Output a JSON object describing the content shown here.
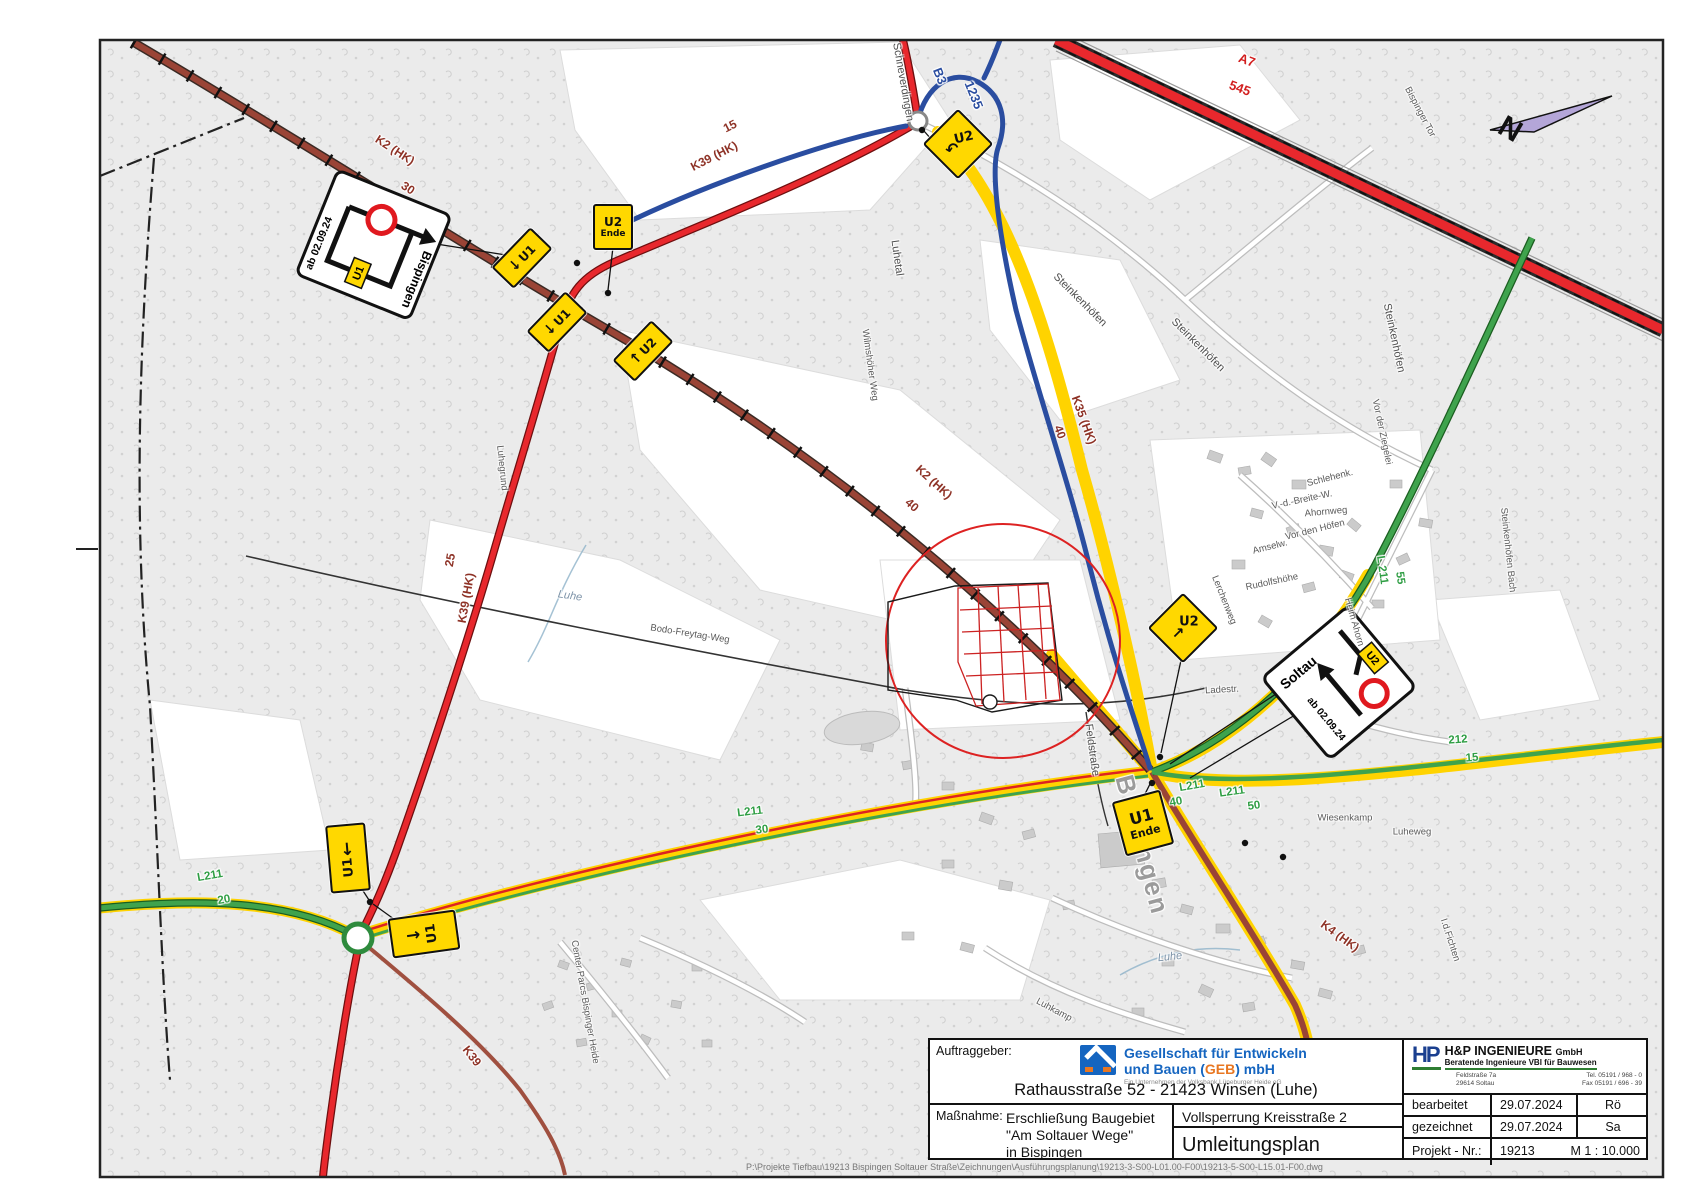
{
  "title_block": {
    "client_label": "Auftraggeber:",
    "client": {
      "name_line1": "Gesellschaft für Entwickeln",
      "name_line2_pre": "und Bauen (",
      "name_geb": "GEB",
      "name_line2_post": ") mbH",
      "sub": "Ein Unternehmen der Volksbank Lüneburger Heide eG",
      "address": "Rathausstraße 52 - 21423 Winsen (Luhe)"
    },
    "measure_label": "Maßnahme:",
    "measure_line1": "Erschließung Baugebiet",
    "measure_line2": "\"Am Soltauer Wege\"",
    "measure_line3": "in Bispingen",
    "closure": "Vollsperrung Kreisstraße 2",
    "plan_title": "Umleitungsplan",
    "engineer": {
      "logo": "HP",
      "name": "H&P INGENIEURE",
      "suffix": "GmbH",
      "sub": "Beratende Ingenieure VBI für Bauwesen",
      "addr1": "Feldstraße 7a",
      "addr2": "29614 Soltau",
      "tel": "Tel. 05191 / 968 - 0",
      "fax": "Fax 05191 / 696 - 39"
    },
    "rows": [
      {
        "label": "bearbeitet",
        "date": "29.07.2024",
        "by": "Rö"
      },
      {
        "label": "gezeichnet",
        "date": "29.07.2024",
        "by": "Sa"
      }
    ],
    "project_label": "Projekt - Nr.:",
    "project_no": "19213",
    "scale": "M 1 : 10.000"
  },
  "page": {
    "file_path": "P:\\Projekte Tiefbau\\19213 Bispingen Soltauer Straße\\Zeichnungen\\Ausführungsplanung\\19213-3-S00-L01.00-F00\\19213-5-S00-L15.01-F00.dwg"
  },
  "signs": {
    "bispingen": {
      "dest": "Bispingen",
      "date": "ab 02.09.24",
      "badge": "U1"
    },
    "soltau": {
      "dest": "Soltau",
      "date": "ab 02.09.24",
      "badge": "U2"
    }
  },
  "map": {
    "north": "N",
    "labels": [
      {
        "t": "Schneverdingen",
        "x": 903,
        "y": 82,
        "r": 80,
        "c": "m"
      },
      {
        "t": "B3",
        "x": 940,
        "y": 76,
        "r": 68,
        "c": "bl"
      },
      {
        "t": "1235",
        "x": 974,
        "y": 95,
        "r": 68,
        "c": "bl"
      },
      {
        "t": "A7",
        "x": 1247,
        "y": 60,
        "r": 20,
        "c": "rr"
      },
      {
        "t": "545",
        "x": 1240,
        "y": 88,
        "r": 20,
        "c": "rr"
      },
      {
        "t": "Bispinger Tor",
        "x": 1420,
        "y": 112,
        "r": 62,
        "c": "s"
      },
      {
        "t": "K2 (HK)",
        "x": 395,
        "y": 150,
        "r": 33,
        "c": "rb"
      },
      {
        "t": "30",
        "x": 408,
        "y": 188,
        "r": 33,
        "c": "rb"
      },
      {
        "t": "K39 (HK)",
        "x": 714,
        "y": 156,
        "r": -27,
        "c": "rb"
      },
      {
        "t": "15",
        "x": 730,
        "y": 126,
        "r": -27,
        "c": "rb"
      },
      {
        "t": "Luhetal",
        "x": 897,
        "y": 258,
        "r": 82,
        "c": "m"
      },
      {
        "t": "Wilmshöher Weg",
        "x": 870,
        "y": 365,
        "r": 82,
        "c": "s"
      },
      {
        "t": "Steinkenhöfen",
        "x": 1080,
        "y": 300,
        "r": 45,
        "c": "m"
      },
      {
        "t": "Steinkenhöfen",
        "x": 1198,
        "y": 345,
        "r": 45,
        "c": "m"
      },
      {
        "t": "Steinkenhöfen",
        "x": 1394,
        "y": 338,
        "r": 78,
        "c": "m"
      },
      {
        "t": "Vor der Ziegelei",
        "x": 1382,
        "y": 432,
        "r": 78,
        "c": "s"
      },
      {
        "t": "Steinkenhöfen Bach",
        "x": 1508,
        "y": 550,
        "r": 84,
        "c": "s"
      },
      {
        "t": "K35 (HK)",
        "x": 1084,
        "y": 420,
        "r": 70,
        "c": "rb"
      },
      {
        "t": "40",
        "x": 1060,
        "y": 432,
        "r": 70,
        "c": "rb"
      },
      {
        "t": "K2 (HK)",
        "x": 934,
        "y": 482,
        "r": 42,
        "c": "rb"
      },
      {
        "t": "40",
        "x": 912,
        "y": 505,
        "r": 42,
        "c": "rb"
      },
      {
        "t": "25",
        "x": 450,
        "y": 560,
        "r": -80,
        "c": "rb"
      },
      {
        "t": "K39 (HK)",
        "x": 466,
        "y": 598,
        "r": -80,
        "c": "rb"
      },
      {
        "t": "Luhe",
        "x": 570,
        "y": 596,
        "r": 8,
        "c": "w"
      },
      {
        "t": "Bodo-Freytag-Weg",
        "x": 690,
        "y": 634,
        "r": 9,
        "c": "s"
      },
      {
        "t": "Luhegrund",
        "x": 502,
        "y": 468,
        "r": 84,
        "c": "s"
      },
      {
        "t": "L 211",
        "x": 1382,
        "y": 570,
        "r": 82,
        "c": "gr"
      },
      {
        "t": "55",
        "x": 1400,
        "y": 578,
        "r": 82,
        "c": "gr"
      },
      {
        "t": "Amselw.",
        "x": 1270,
        "y": 547,
        "r": -14,
        "c": "s"
      },
      {
        "t": "Rudolfshöhe",
        "x": 1272,
        "y": 582,
        "r": -12,
        "c": "s"
      },
      {
        "t": "Lerchenweg",
        "x": 1224,
        "y": 600,
        "r": 68,
        "c": "s"
      },
      {
        "t": "Vor den Höfen",
        "x": 1315,
        "y": 530,
        "r": -14,
        "c": "s"
      },
      {
        "t": "Ahornweg",
        "x": 1326,
        "y": 512,
        "r": -5,
        "c": "s"
      },
      {
        "t": "Schlehenk.",
        "x": 1330,
        "y": 478,
        "r": -14,
        "c": "s"
      },
      {
        "t": "V.-d.-Breite-W.",
        "x": 1302,
        "y": 500,
        "r": -12,
        "c": "s"
      },
      {
        "t": "Heim Ahorn",
        "x": 1354,
        "y": 622,
        "r": 74,
        "c": "s"
      },
      {
        "t": "Feldstraße",
        "x": 1092,
        "y": 750,
        "r": 82,
        "c": "m"
      },
      {
        "t": "Ladestr.",
        "x": 1222,
        "y": 690,
        "r": -3,
        "c": "s"
      },
      {
        "t": "L211",
        "x": 750,
        "y": 812,
        "r": -7,
        "c": "gr"
      },
      {
        "t": "30",
        "x": 762,
        "y": 830,
        "r": -7,
        "c": "gr"
      },
      {
        "t": "L211",
        "x": 1192,
        "y": 786,
        "r": -10,
        "c": "gr"
      },
      {
        "t": "40",
        "x": 1176,
        "y": 802,
        "r": -10,
        "c": "gr"
      },
      {
        "t": "L211",
        "x": 1232,
        "y": 792,
        "r": -8,
        "c": "gr"
      },
      {
        "t": "50",
        "x": 1254,
        "y": 806,
        "r": -8,
        "c": "gr"
      },
      {
        "t": "212",
        "x": 1458,
        "y": 740,
        "r": -4,
        "c": "gr"
      },
      {
        "t": "15",
        "x": 1472,
        "y": 758,
        "r": -4,
        "c": "gr"
      },
      {
        "t": "L211",
        "x": 210,
        "y": 876,
        "r": -10,
        "c": "gr"
      },
      {
        "t": "20",
        "x": 224,
        "y": 900,
        "r": -10,
        "c": "gr"
      },
      {
        "t": "Wiesenkamp",
        "x": 1345,
        "y": 818,
        "r": 0,
        "c": "s"
      },
      {
        "t": "Luheweg",
        "x": 1412,
        "y": 832,
        "r": 0,
        "c": "s"
      },
      {
        "t": "K4 (HK)",
        "x": 1340,
        "y": 936,
        "r": 36,
        "c": "rb"
      },
      {
        "t": "Luhe",
        "x": 1170,
        "y": 957,
        "r": -6,
        "c": "w"
      },
      {
        "t": "Luhkamp",
        "x": 1054,
        "y": 1010,
        "r": 28,
        "c": "s"
      },
      {
        "t": "Center Parcs Bispinger Heide",
        "x": 585,
        "y": 1002,
        "r": 80,
        "c": "s"
      },
      {
        "t": "Bispingen",
        "x": 1142,
        "y": 845,
        "r": 75,
        "c": "t"
      },
      {
        "t": "K39",
        "x": 472,
        "y": 1056,
        "r": 52,
        "c": "rb"
      },
      {
        "t": "I.d.Fichten",
        "x": 1450,
        "y": 940,
        "r": 72,
        "c": "s"
      }
    ],
    "usigns": [
      {
        "n": "u2-uturn-sign",
        "x": 958,
        "y": 144,
        "r": 45,
        "w": 46,
        "h": 46,
        "dir": "col",
        "items": [
          {
            "t": "U2",
            "r": -58,
            "fs": 13
          },
          {
            "t": "↶",
            "r": -58,
            "fs": 16
          }
        ]
      },
      {
        "n": "u2-ende-sign",
        "x": 613,
        "y": 227,
        "r": 0,
        "w": 36,
        "h": 42,
        "dir": "col",
        "items": [
          {
            "t": "U2",
            "r": 0,
            "fs": 12
          },
          {
            "t": "Ende",
            "r": 0,
            "fs": 9
          }
        ]
      },
      {
        "n": "u1-arrow-sign",
        "x": 522,
        "y": 258,
        "r": -46,
        "w": 52,
        "h": 27,
        "dir": "row",
        "items": [
          {
            "t": "↓",
            "r": 0,
            "fs": 14
          },
          {
            "t": "U1",
            "r": 0,
            "fs": 12
          }
        ]
      },
      {
        "n": "u1-arrow-sign",
        "x": 557,
        "y": 322,
        "r": -46,
        "w": 52,
        "h": 27,
        "dir": "row",
        "items": [
          {
            "t": "↓",
            "r": 0,
            "fs": 14
          },
          {
            "t": "U1",
            "r": 0,
            "fs": 12
          }
        ]
      },
      {
        "n": "u2-arrow-sign",
        "x": 643,
        "y": 351,
        "r": -46,
        "w": 52,
        "h": 27,
        "dir": "row",
        "items": [
          {
            "t": "↑",
            "r": 0,
            "fs": 14
          },
          {
            "t": "U2",
            "r": 0,
            "fs": 12
          }
        ]
      },
      {
        "n": "u2-arrow-sign",
        "x": 1183,
        "y": 628,
        "r": 45,
        "w": 46,
        "h": 46,
        "dir": "col",
        "items": [
          {
            "t": "U2",
            "r": -45,
            "fs": 13
          },
          {
            "t": "↗",
            "r": -45,
            "fs": 15
          }
        ]
      },
      {
        "n": "u1-ende-sign",
        "x": 1143,
        "y": 823,
        "r": -15,
        "w": 46,
        "h": 52,
        "dir": "col",
        "items": [
          {
            "t": "U1",
            "r": 0,
            "fs": 16
          },
          {
            "t": "Ende",
            "r": 0,
            "fs": 11
          }
        ]
      },
      {
        "n": "u1-arrow-sign",
        "x": 348,
        "y": 858,
        "r": -5,
        "w": 36,
        "h": 64,
        "dir": "col",
        "items": [
          {
            "t": "↓",
            "r": 0,
            "fs": 17
          },
          {
            "t": "U1",
            "r": -90,
            "fs": 13
          }
        ]
      },
      {
        "n": "u1-arrow-sign",
        "x": 424,
        "y": 934,
        "r": -8,
        "w": 64,
        "h": 36,
        "dir": "row",
        "items": [
          {
            "t": "→",
            "r": 0,
            "fs": 17
          },
          {
            "t": "U1",
            "r": -90,
            "fs": 13
          }
        ]
      }
    ]
  }
}
